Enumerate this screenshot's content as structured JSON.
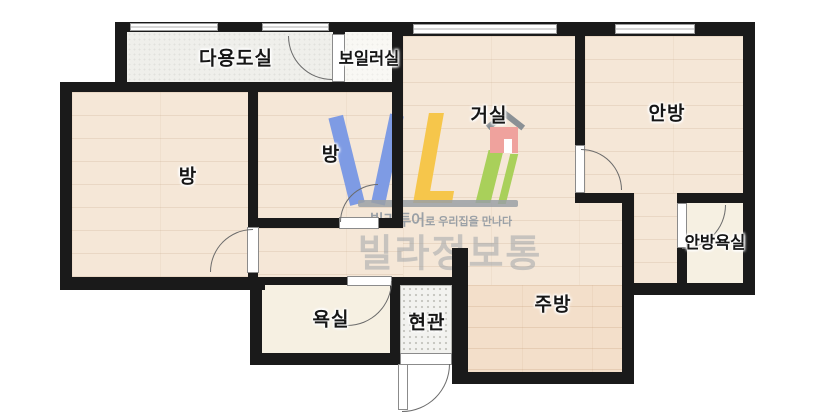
{
  "floorplan": {
    "rooms": [
      {
        "id": "utility",
        "label": "다용도실"
      },
      {
        "id": "boiler",
        "label": "보일러실"
      },
      {
        "id": "room-left",
        "label": "방"
      },
      {
        "id": "room-middle",
        "label": "방"
      },
      {
        "id": "living",
        "label": "거실"
      },
      {
        "id": "master-bedroom",
        "label": "안방"
      },
      {
        "id": "master-bathroom",
        "label": "안방욕실"
      },
      {
        "id": "bathroom",
        "label": "욕실"
      },
      {
        "id": "entrance",
        "label": "현관"
      },
      {
        "id": "kitchen",
        "label": "주방"
      }
    ],
    "watermark": {
      "tagline_strong": "빌라투어",
      "tagline_rest": "로 우리집을 만나다",
      "brand": "빌라정보통"
    },
    "colors": {
      "wall": "#1a1a1a",
      "wood": "#f5e7d7",
      "wood-deep": "#f3dfca",
      "tile": "#f6f0e2",
      "utility-floor": "#efefeb",
      "boiler-floor": "#f9f8f4",
      "entry-floor": "#f2f2ef",
      "logo-blue": "#7e9be4",
      "logo-yellow": "#f6c64b",
      "logo-green": "#a9d05a",
      "logo-pink": "#efa29d",
      "logo-roof": "#8a9095",
      "logo-gray": "#9aa0a6"
    }
  }
}
